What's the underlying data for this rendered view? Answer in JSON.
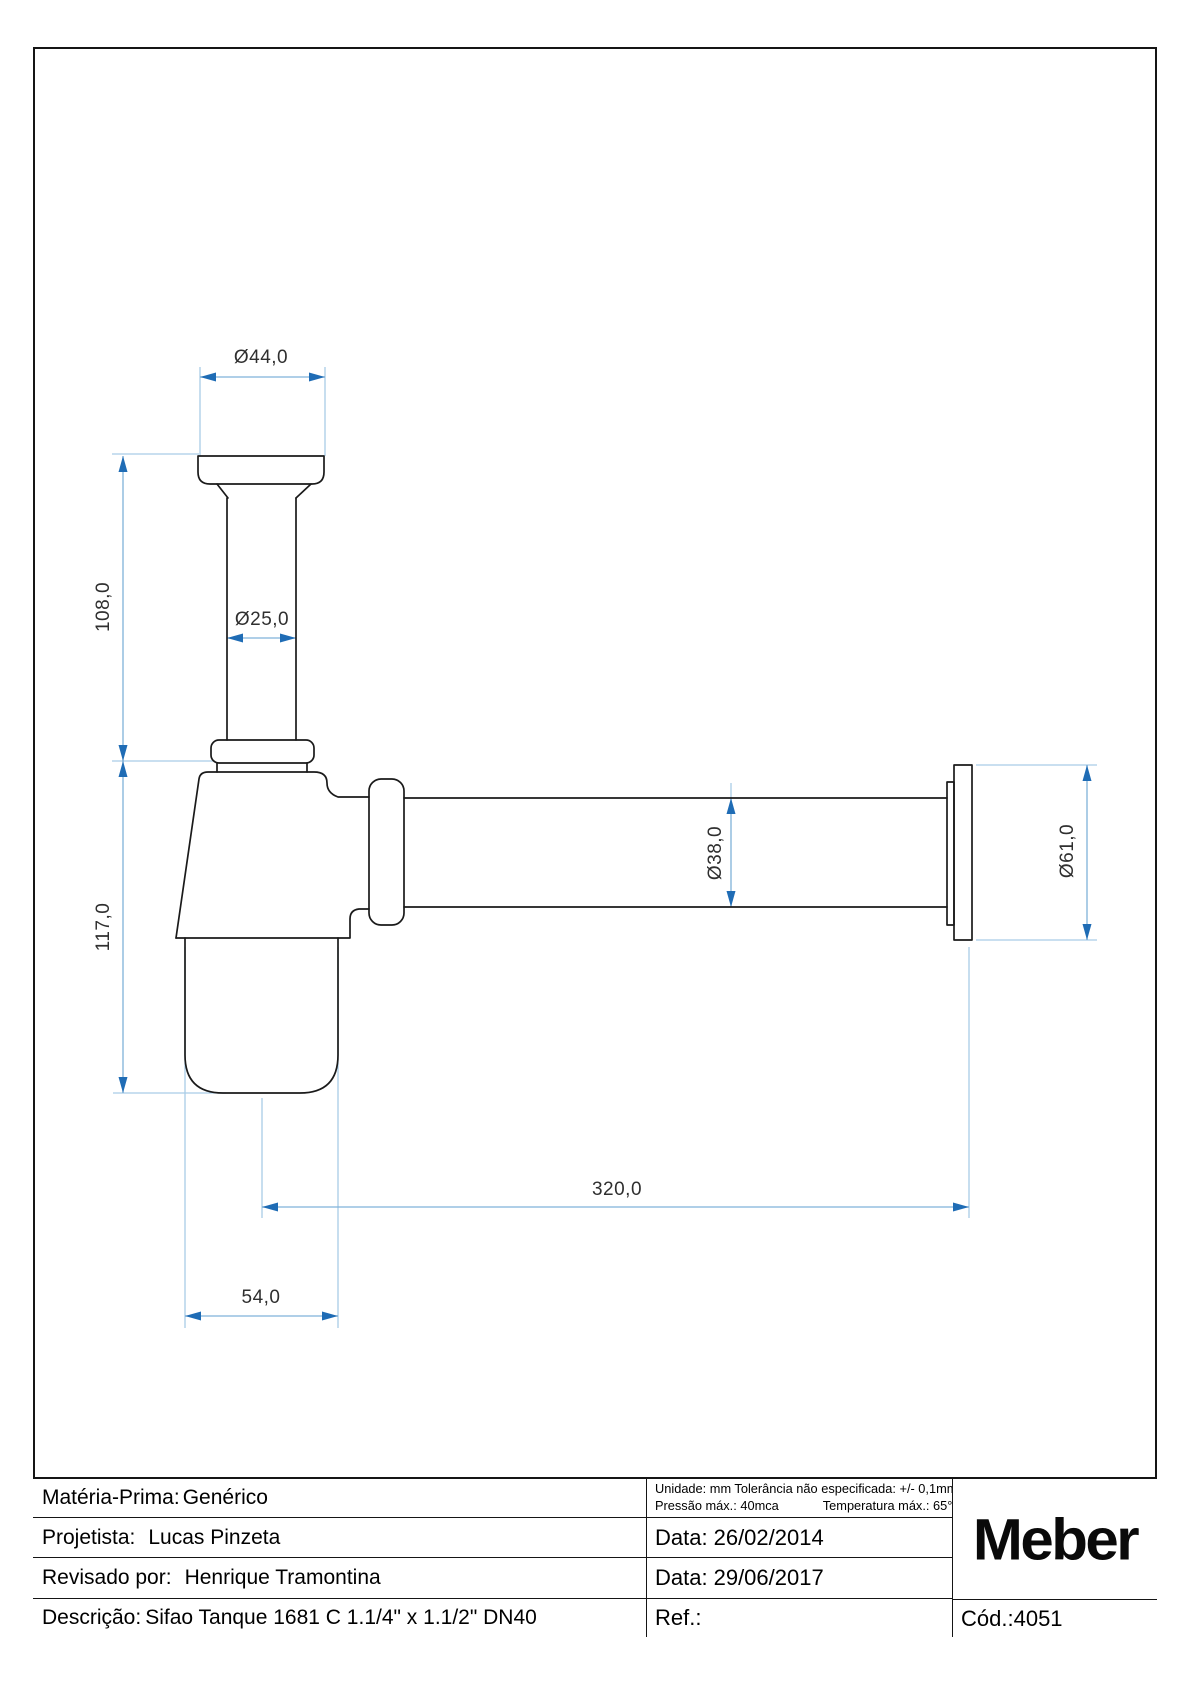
{
  "drawing": {
    "dimensions": {
      "top_flange_diameter": "Ø44,0",
      "inlet_tube_height": "108,0",
      "inlet_tube_diameter": "Ø25,0",
      "body_height": "117,0",
      "outlet_pipe_diameter": "Ø38,0",
      "wall_flange_diameter": "Ø61,0",
      "outlet_length": "320,0",
      "cup_diameter": "54,0"
    },
    "colors": {
      "outline": "#1a1a1a",
      "dimension_line": "#7fb2d9",
      "extension_line": "#a9cce6",
      "arrow": "#1f6cb5"
    }
  },
  "title_block": {
    "rows": [
      {
        "label": "Matéria-Prima:",
        "value": "Genérico"
      },
      {
        "label": "Projetista:",
        "value": "Lucas Pinzeta"
      },
      {
        "label": "Revisado por:",
        "value": "Henrique Tramontina"
      },
      {
        "label": "Descrição:",
        "value": "Sifao Tanque 1681 C 1.1/4\" x 1.1/2\" DN40"
      }
    ],
    "specs": {
      "line1": "Unidade: mm Tolerância não especificada: +/- 0,1mm",
      "line2_left": "Pressão máx.: 40mca",
      "line2_right": "Temperatura máx.: 65°C"
    },
    "dates": {
      "created_label": "Data:",
      "created": "26/02/2014",
      "revised_label": "Data:",
      "revised": "29/06/2017"
    },
    "ref_label": "Ref.:",
    "code_label": "Cód.:",
    "code": "4051",
    "brand": "Meber"
  }
}
